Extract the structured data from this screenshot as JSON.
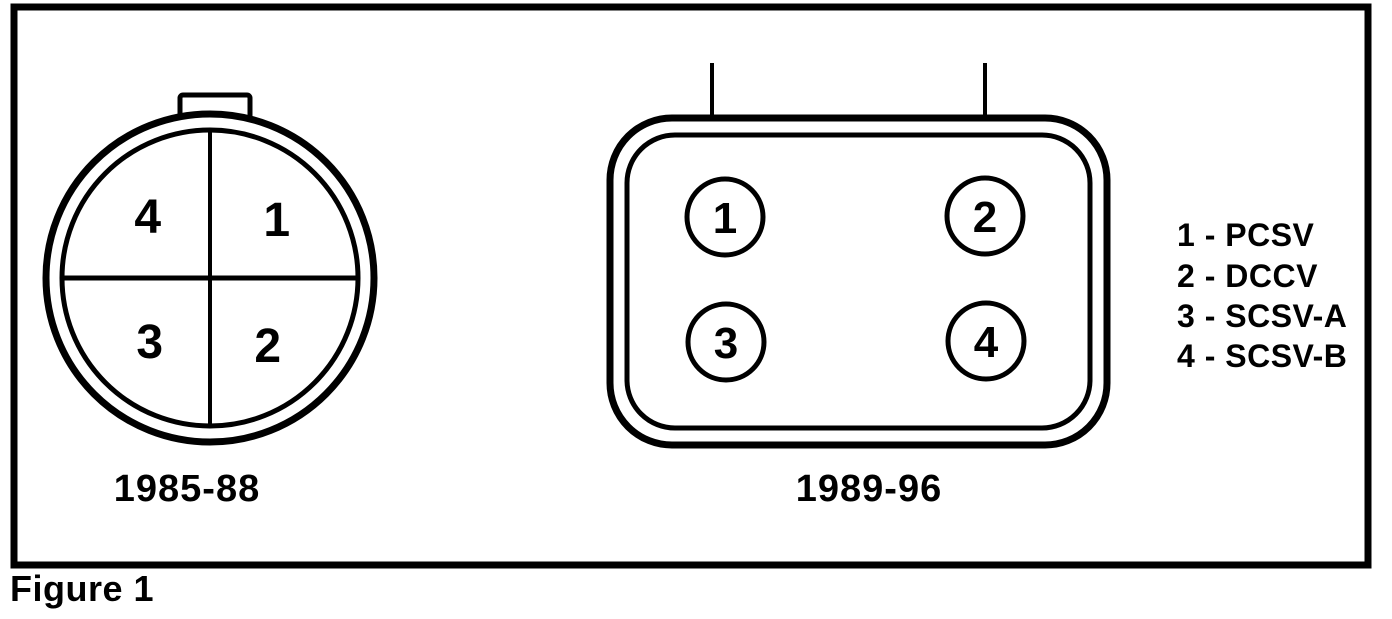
{
  "figure": {
    "caption": "Figure 1"
  },
  "diagram": {
    "round_connector": {
      "label": "1985-88",
      "pins": {
        "top_left": "4",
        "top_right": "1",
        "bottom_left": "3",
        "bottom_right": "2"
      }
    },
    "rect_connector": {
      "label": "1989-96",
      "pins": {
        "top_left": "1",
        "top_right": "2",
        "bottom_left": "3",
        "bottom_right": "4"
      }
    },
    "legend": {
      "items": [
        "1 - PCSV",
        "2 - DCCV",
        "3 - SCSV-A",
        "4 - SCSV-B"
      ]
    }
  },
  "colors": {
    "ink": "#000000",
    "paper": "#ffffff"
  }
}
